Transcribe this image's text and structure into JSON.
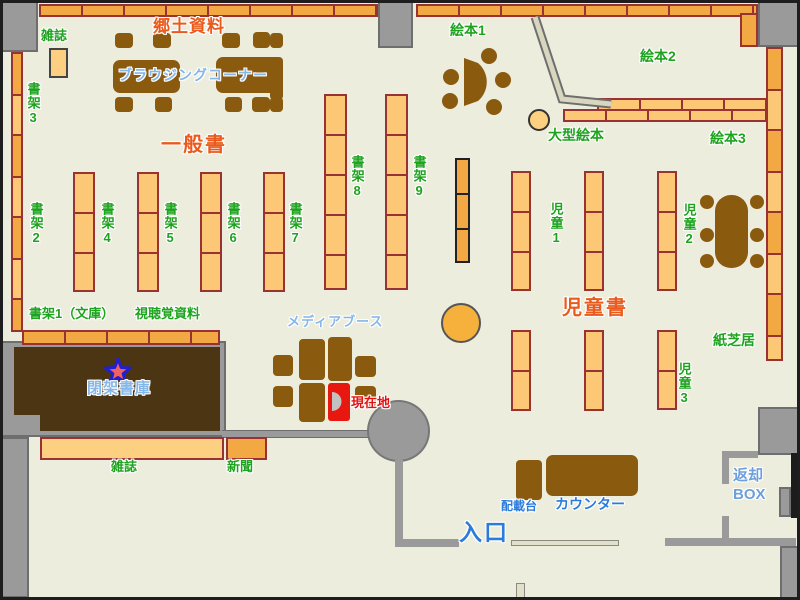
{
  "map_title": "library-floor-map",
  "areas": {
    "kyodo_shiryo": "郷土資料",
    "ippansho": "一般書",
    "jidosho": "児童書"
  },
  "labels": {
    "zasshi_top": "雑誌",
    "browsing_corner": "ブラウジングコーナー",
    "shoka3": "書架3",
    "shoka2": "書架2",
    "shoka4": "書架4",
    "shoka5": "書架5",
    "shoka6": "書架6",
    "shoka7": "書架7",
    "shoka8": "書架8",
    "shoka9": "書架9",
    "ehon1": "絵本1",
    "ehon2": "絵本2",
    "ehon3": "絵本3",
    "ogata_ehon": "大型絵本",
    "jido1": "児童1",
    "jido2": "児童2",
    "jido3": "児童3",
    "kamishibai": "紙芝居",
    "shoka1_bunko": "書架1（文庫）",
    "shichokaku_shiryo": "視聴覚資料",
    "media_booth": "メディアブース",
    "genzaichi": "現在地",
    "heika_shoko": "閉架書庫",
    "zasshi_bottom": "雑誌",
    "shinbun": "新聞",
    "haisaidai": "配載台",
    "counter": "カウンター",
    "henkyaku_line1": "返却",
    "henkyaku_line2": "BOX",
    "iriguchi": "入口"
  },
  "colors": {
    "floor": "#ECEDDC",
    "wall_gray": "#9A9A9A",
    "shelf_light": "#FDC876",
    "shelf_dark": "#F2A843",
    "shelf_border": "#993333",
    "furniture_brown": "#8A5A0F",
    "closed_stack_brown": "#4B3513",
    "current_location_red": "#E8170F",
    "label_green": "#1EA31E",
    "label_orange": "#EA5A1C",
    "label_lightblue": "#85B6E8",
    "label_blue": "#2B7BDB",
    "star_fill": "#F26060",
    "star_stroke": "#2020D0"
  }
}
